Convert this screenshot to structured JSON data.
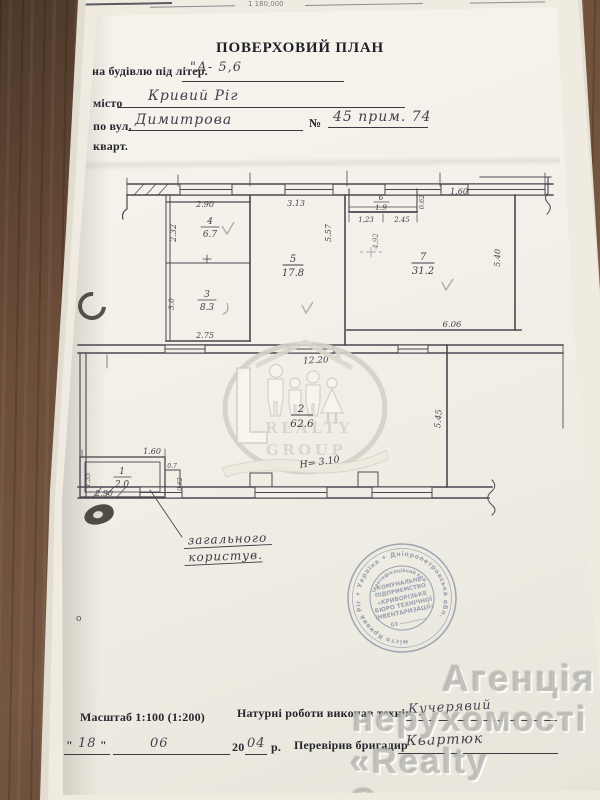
{
  "top_strip": {
    "fragment": "1 180,000"
  },
  "header": {
    "title": "ПОВЕРХОВИЙ ПЛАН",
    "building_label": "на будівлю під літер.",
    "building_value": "\"А- 5,6",
    "city_label": "місто",
    "city_value": "Кривий Ріг",
    "street_label": "по вул.",
    "street_value": "Димитрова",
    "number_label": "№",
    "number_value": "45 прим. 74",
    "apt_label": "кварт."
  },
  "plan": {
    "rooms": [
      {
        "num": "1",
        "area": "2.0"
      },
      {
        "num": "2",
        "area": "62.6"
      },
      {
        "num": "3",
        "area": "8.3"
      },
      {
        "num": "4",
        "area": "6.7"
      },
      {
        "num": "5",
        "area": "17.8"
      },
      {
        "num": "6",
        "area": "1.9"
      },
      {
        "num": "7",
        "area": "31.2"
      }
    ],
    "dims": {
      "top290": "2.90",
      "left232": "2.32",
      "top313": "3.13",
      "v557": "5.57",
      "n123": "1,23",
      "n245": "2.45",
      "v062": "0.62",
      "pencil492": "4,92",
      "top160": "1.60",
      "v540": "5.40",
      "bot606": "6.06",
      "left30": "3.0",
      "bot275": "2.75",
      "w1220": "12.20",
      "v545": "5.45",
      "r1_160": "1.60",
      "r1_290": "2.90",
      "r1_135": "1.35",
      "r1_07": "0.7",
      "r1_062": "0.62"
    },
    "height_note": "Н= 3.10",
    "note_line1": "загального",
    "note_line2": "користув.",
    "small_o": "о"
  },
  "logo": {
    "line1": "REALTY",
    "line2": "GROUP"
  },
  "stamp": {
    "ring": "місто Кривий Ріг ✦ Україна ✦ Дніпропетровська обл.",
    "arc": "Ідентифікаційний код",
    "l1": "КОМУНАЛЬНЕ",
    "l2": "ПІДПРИЄМСТВО",
    "l3": "«КРИВОРІЗЬКЕ",
    "l4": "БЮРО ТЕХНІЧНОЇ",
    "l5": "ІНВЕНТАРИЗАЦІЇ»",
    "l6": "03"
  },
  "watermark": {
    "line1": "Агенція",
    "line2": "нерухомості",
    "line3": "«Realty Group»"
  },
  "footer": {
    "scale": "Масштаб 1:100 (1:200)",
    "work_label": "Натурні роботи виконав технік",
    "work_value": "Кучерявий",
    "q1": "\"",
    "day": "18",
    "q2": "\"",
    "month": "06",
    "year_prefix": "20",
    "year": "04",
    "year_suffix": "р.",
    "check_label": "Перевірив бригадир",
    "check_value": "Квартюк"
  }
}
